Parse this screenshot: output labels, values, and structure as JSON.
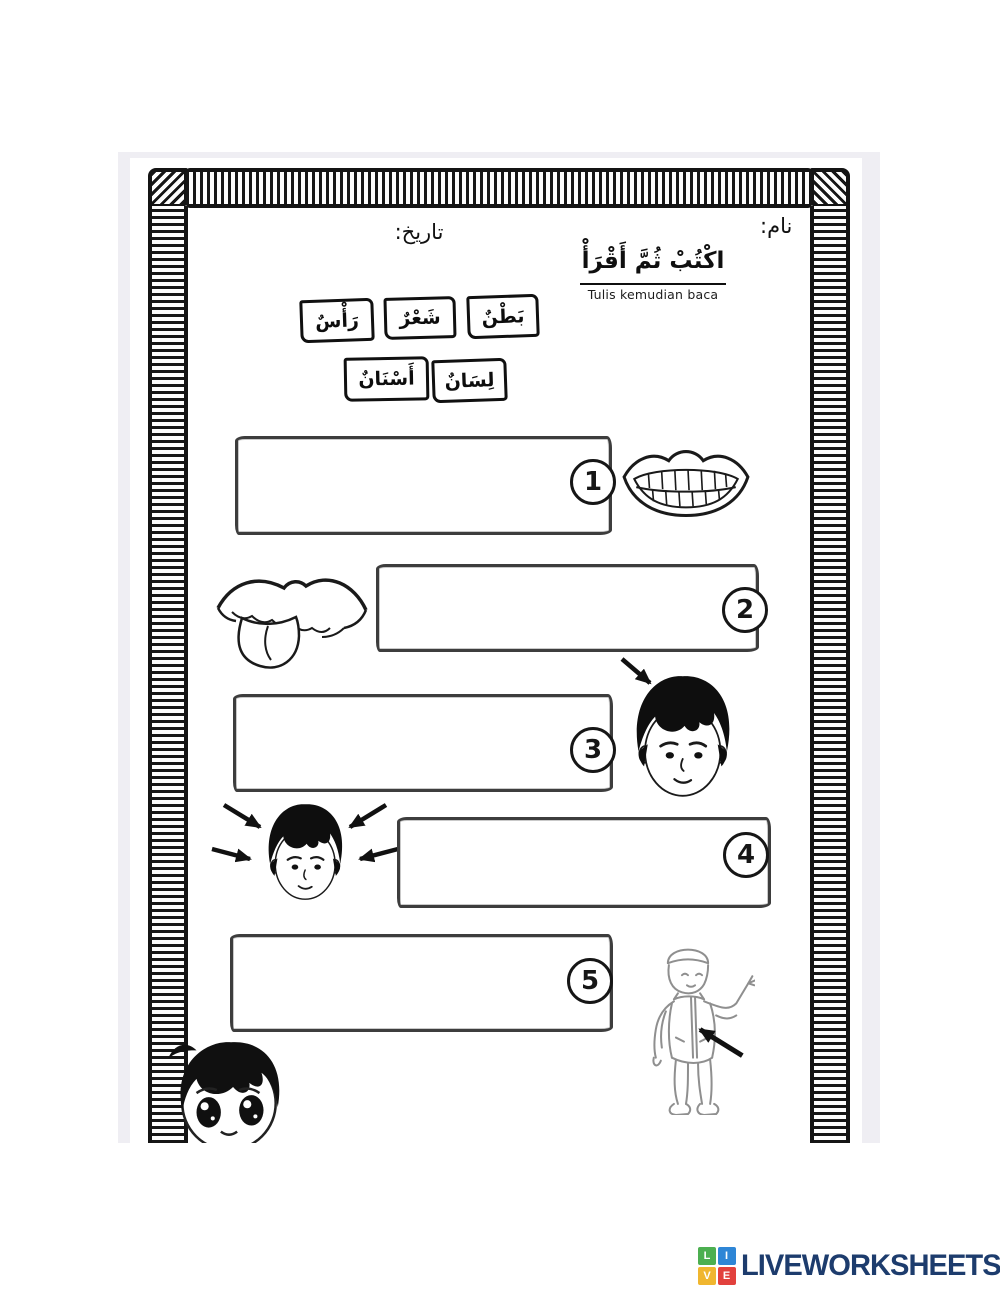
{
  "header": {
    "name_label": "نام:",
    "date_label": "تاريخ:",
    "title_arabic": "اكْتُبْ ثُمَّ أَقْرَأْ",
    "title_translation": "Tulis kemudian baca"
  },
  "word_bank": {
    "items": [
      {
        "text": "رَأْسٌ"
      },
      {
        "text": "شَعْرٌ"
      },
      {
        "text": "بَطْنٌ"
      },
      {
        "text": "أَسْنَانٌ"
      },
      {
        "text": "لِسَانٌ"
      }
    ]
  },
  "questions": [
    {
      "number": "1",
      "answer": "",
      "illustration": "mouth-with-teeth"
    },
    {
      "number": "2",
      "answer": "",
      "illustration": "tongue-out-of-mouth"
    },
    {
      "number": "3",
      "answer": "",
      "illustration": "boy-head-arrow-to-hair"
    },
    {
      "number": "4",
      "answer": "",
      "illustration": "boy-head-four-arrows"
    },
    {
      "number": "5",
      "answer": "",
      "illustration": "standing-boy-arrow-to-belly"
    }
  ],
  "footer": {
    "brand": "LIVEWORKSHEETS",
    "brand_color": "#1d3c6d",
    "icon_tiles": [
      {
        "letter": "L",
        "color": "#4caf50"
      },
      {
        "letter": "I",
        "color": "#2e86d6"
      },
      {
        "letter": "V",
        "color": "#f0b62f"
      },
      {
        "letter": "E",
        "color": "#e2413d"
      }
    ]
  }
}
